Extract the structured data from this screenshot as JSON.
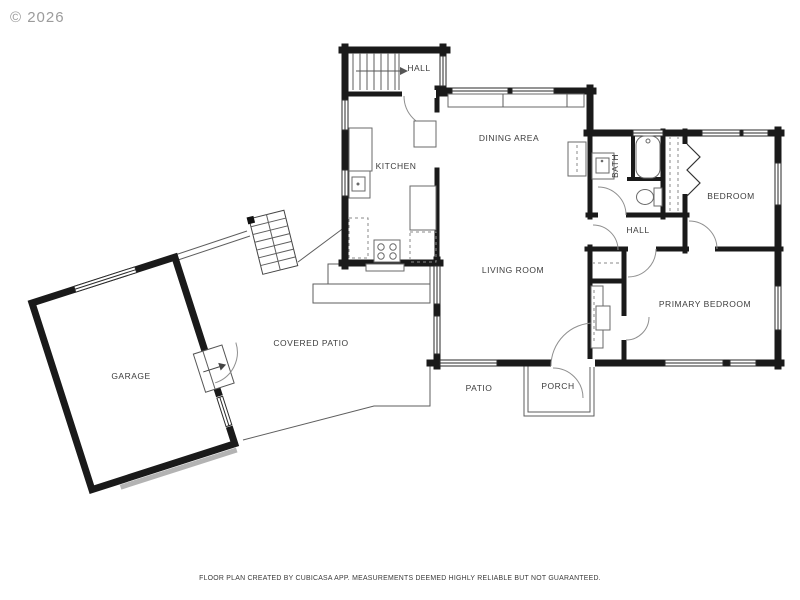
{
  "watermark": "© 2026",
  "disclaimer": "FLOOR PLAN CREATED BY CUBICASA APP. MEASUREMENTS DEEMED HIGHLY RELIABLE BUT NOT GUARANTEED.",
  "source_app": "CubiCasa",
  "colors": {
    "wall": "#1a1a1a",
    "thin_line": "#5e5e5e",
    "garage_door": "#b3b3b3",
    "label": "#3d3d3d",
    "watermark": "#9b9b9b",
    "background": "#ffffff"
  },
  "rooms": [
    {
      "id": "hall-upper",
      "label": "HALL"
    },
    {
      "id": "kitchen",
      "label": "KITCHEN"
    },
    {
      "id": "dining-area",
      "label": "DINING AREA"
    },
    {
      "id": "bath",
      "label": "BATH"
    },
    {
      "id": "bedroom",
      "label": "BEDROOM"
    },
    {
      "id": "hall-main",
      "label": "HALL"
    },
    {
      "id": "living-room",
      "label": "LIVING ROOM"
    },
    {
      "id": "primary-bedroom",
      "label": "PRIMARY BEDROOM"
    },
    {
      "id": "garage",
      "label": "GARAGE"
    },
    {
      "id": "covered-patio",
      "label": "COVERED PATIO"
    },
    {
      "id": "patio",
      "label": "PATIO"
    },
    {
      "id": "porch",
      "label": "PORCH"
    }
  ],
  "features": {
    "stairs": [
      "upper-hall-staircase",
      "exterior-staircase"
    ],
    "fixtures": [
      "kitchen-sink",
      "stove",
      "bathtub",
      "toilet",
      "bath-sink",
      "fireplace"
    ]
  }
}
